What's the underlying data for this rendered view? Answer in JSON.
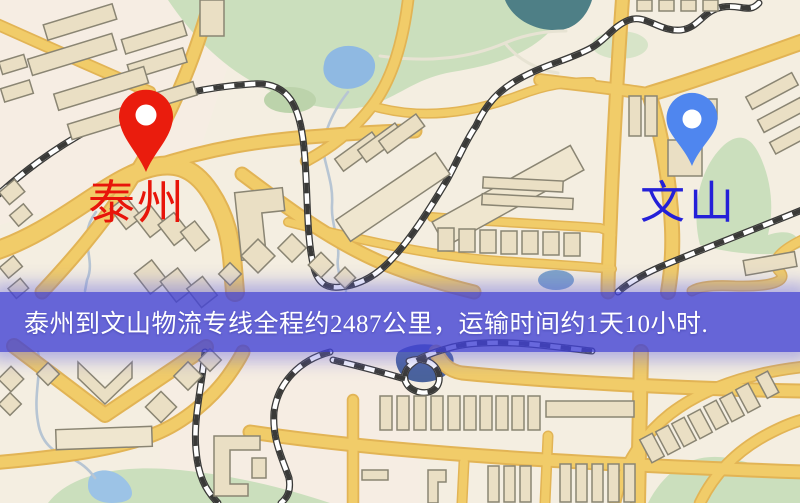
{
  "window": {
    "width": 800,
    "height": 503
  },
  "origin": {
    "label": "泰州",
    "label_color": "#e8150a",
    "pin_color": "#ea1c0d"
  },
  "destination": {
    "label": "文山",
    "label_color": "#2420d8",
    "pin_color": "#4f86ef"
  },
  "banner": {
    "text": "泰州到文山物流专线全程约2487公里，运输时间约1天10小时.",
    "distance_km": "2487",
    "duration": "1天10小时",
    "background": "#4242d4",
    "text_color": "#ffffff"
  },
  "palette": {
    "background": "#f4eee1",
    "road": "#f1cc69",
    "road_edge": "#e2b455",
    "building": "#eadfc4",
    "building_outline": "#8a8573",
    "park": "#cbdfbd",
    "park_dark": "#bcd3ab",
    "water_light": "#9cc3e6",
    "water_teal": "#4e7f86",
    "water_dark": "#4a639c",
    "railway": "#3a3a38",
    "banner_overlay": "#4242d4"
  }
}
